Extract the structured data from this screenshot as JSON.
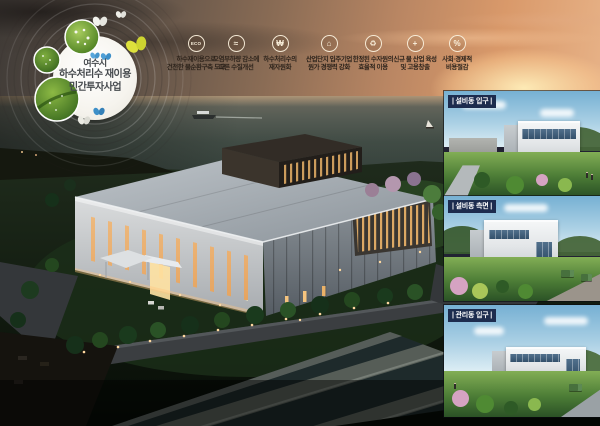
{
  "emblem": {
    "line1": "여수시",
    "line2": "하수처리수 재이용",
    "line3": "민간투자사업"
  },
  "benefits": [
    {
      "icon": "eco-icon",
      "glyph": "ECO",
      "line1": "하수재이용으로",
      "line2": "건전한 물순환구축 도모"
    },
    {
      "icon": "water-drop-icon",
      "glyph": "≈",
      "line1": "오염부하량 감소에",
      "line2": "따른 수질개선"
    },
    {
      "icon": "money-bag-icon",
      "glyph": "₩",
      "line1": "하수처리수의",
      "line2": "재자원화"
    },
    {
      "icon": "factory-icon",
      "glyph": "⌂",
      "line1": "산업단지 입주기업",
      "line2": "원가 경쟁력 강화"
    },
    {
      "icon": "recycle-icon",
      "glyph": "♻",
      "line1": "한정된 수자원의",
      "line2": "효율적 이용"
    },
    {
      "icon": "growth-icon",
      "glyph": "+",
      "line1": "신규 물 산업 육성",
      "line2": "및 고용창출"
    },
    {
      "icon": "savings-icon",
      "glyph": "%",
      "line1": "사회·경제적",
      "line2": "비용절감"
    }
  ],
  "panels": [
    {
      "label": "| 설비동 입구 |"
    },
    {
      "label": "| 설비동 측면 |"
    },
    {
      "label": "| 관리동 입구 |"
    }
  ],
  "colors": {
    "panel_label_bg": "#1d2c4e",
    "sunset_accent": "#d9996a",
    "window_glow": "#f2c47c"
  }
}
